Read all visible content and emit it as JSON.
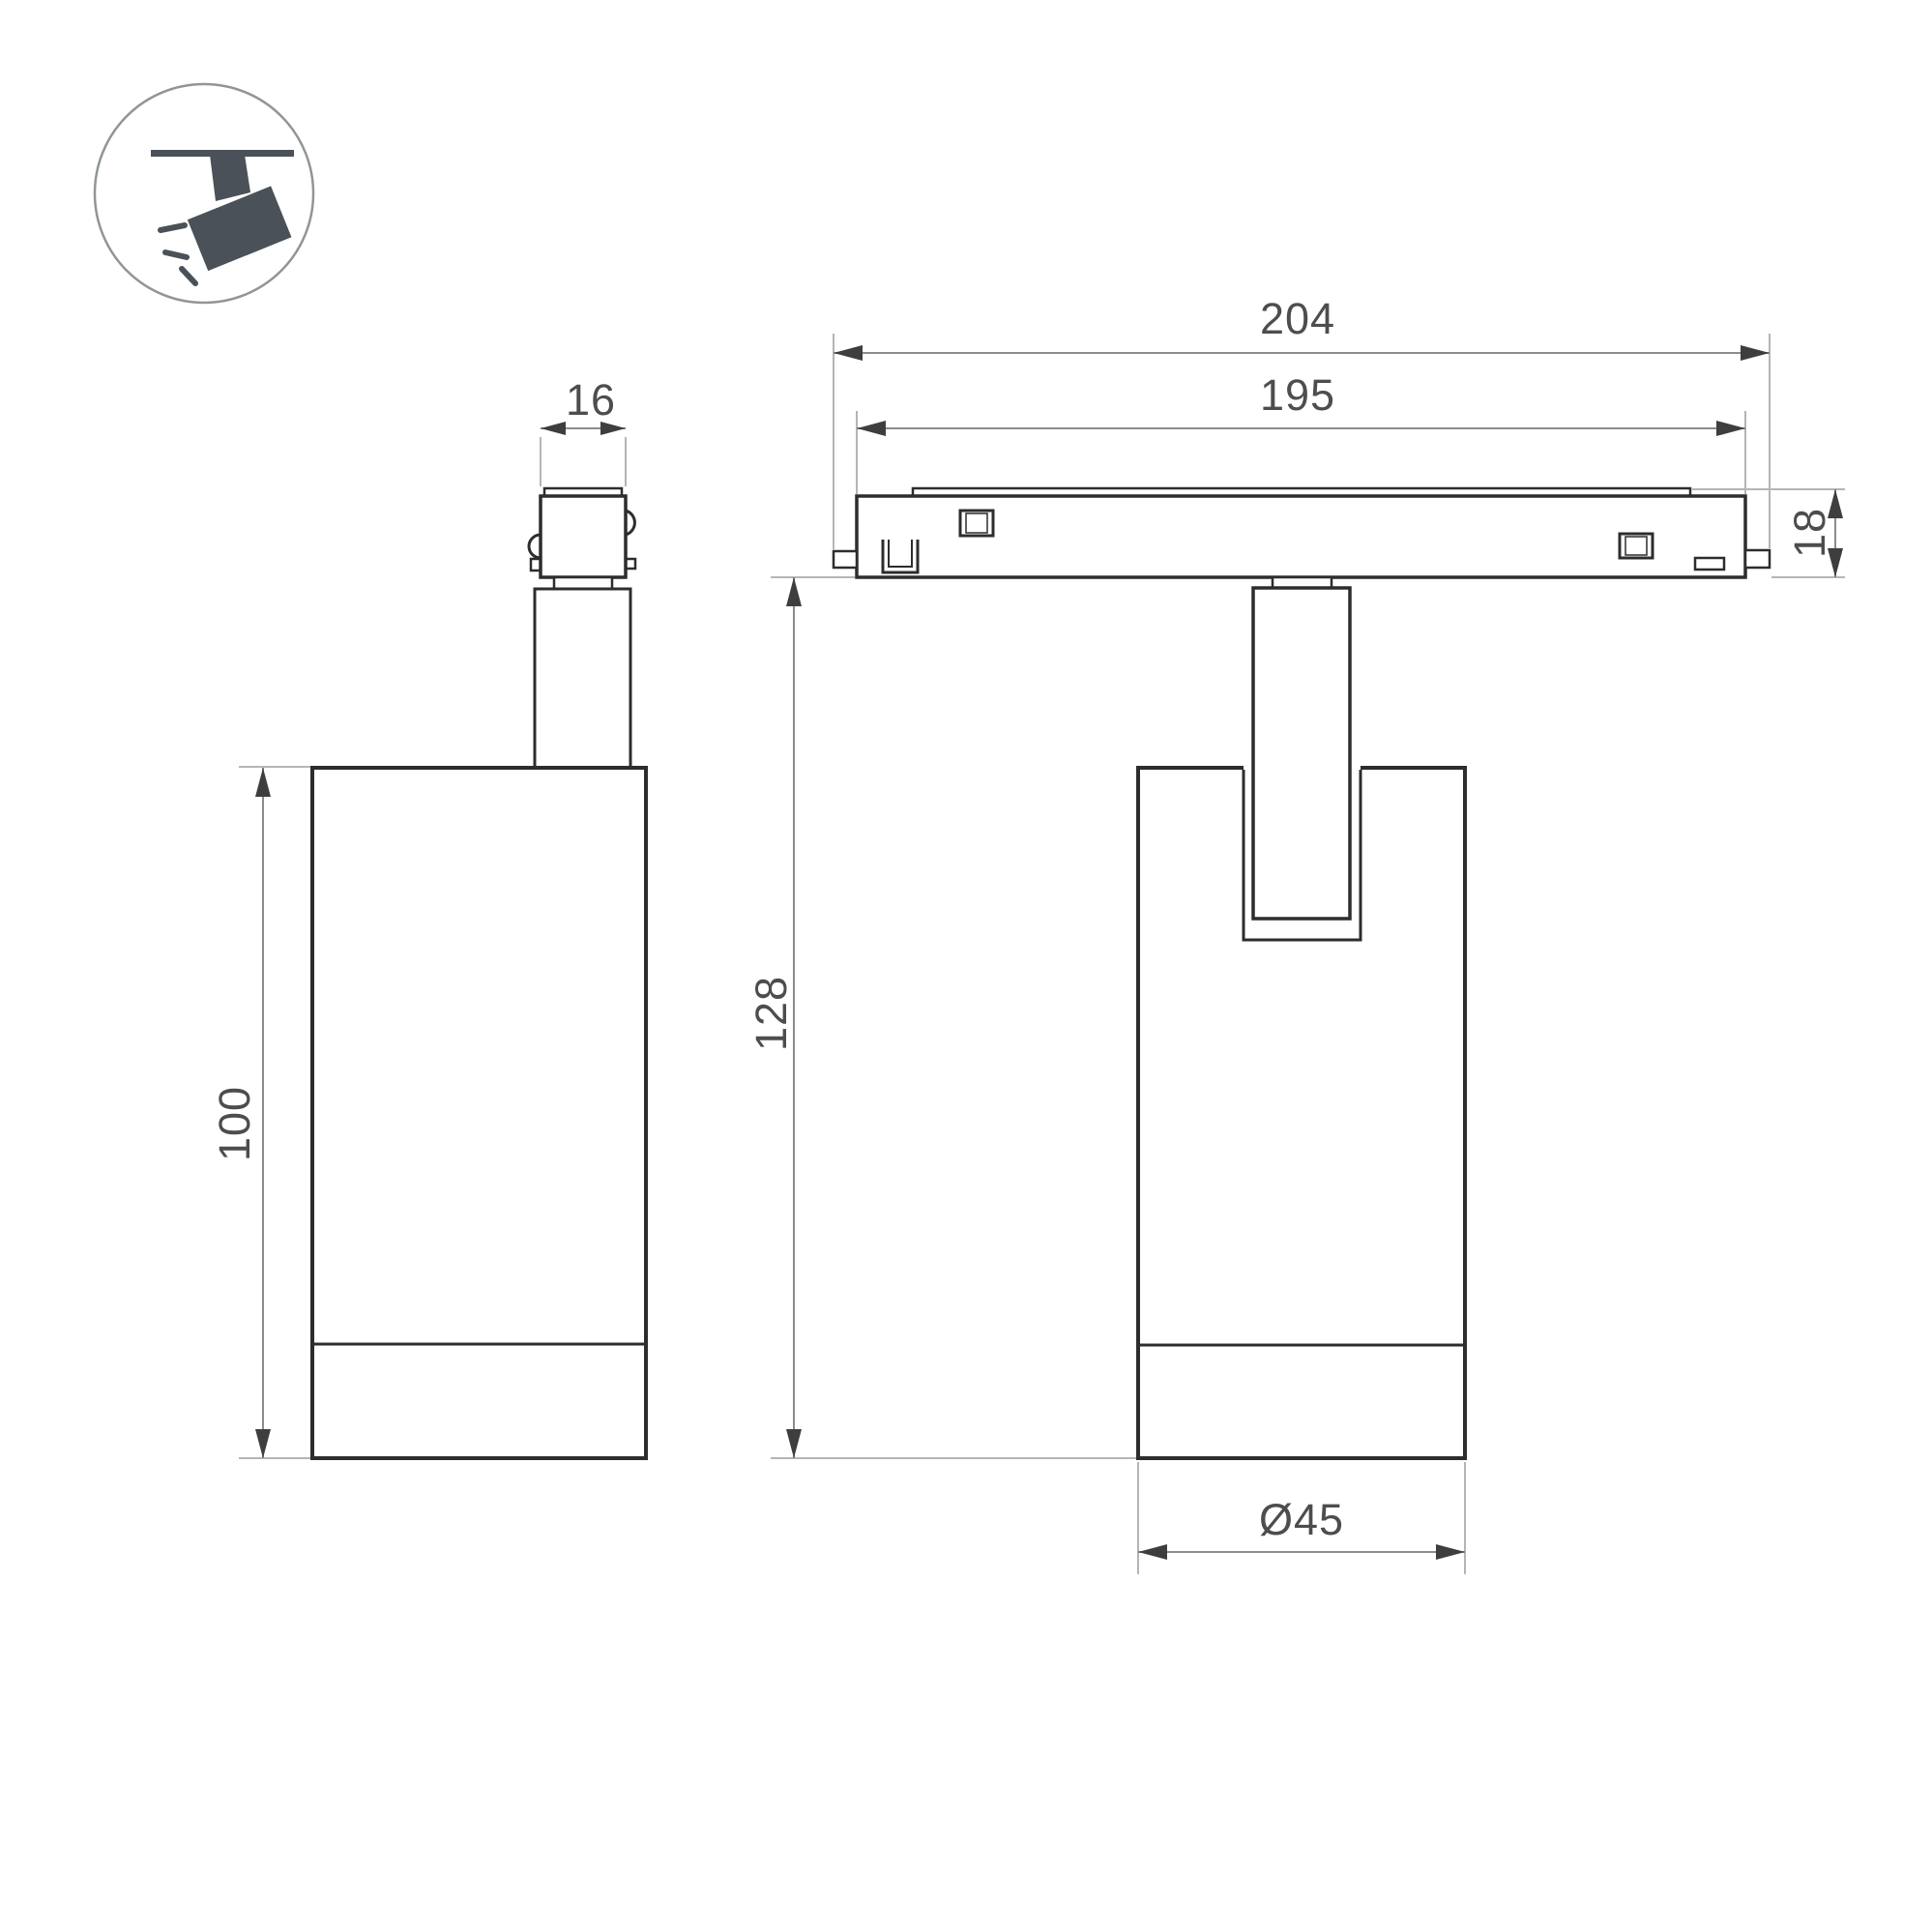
{
  "drawing": {
    "type": "technical-dimension-drawing",
    "subject": "magnetic track spotlight luminaire, two orthographic views",
    "icon": {
      "name": "track-spotlight-icon",
      "description": "spotlight hanging from ceiling track, tilted, emitting light rays"
    },
    "dims": {
      "d16": "16",
      "d204": "204",
      "d195": "195",
      "d18": "18",
      "d100": "100",
      "d128": "128",
      "d45": "Ø45"
    },
    "dimension_meanings": {
      "d16": "adapter width",
      "d204": "track adapter overall length",
      "d195": "track adapter body length",
      "d18": "track adapter height",
      "d100": "lamp body height",
      "d128": "overall hanging height below track",
      "d45": "lamp body diameter"
    },
    "colors": {
      "background": "#ffffff",
      "outline_dark": "#2d2d2d",
      "dim_line": "#8c8c8c",
      "extension_line": "#b5b5b5",
      "arrowhead": "#3e3e3e",
      "dim_text": "#4d4d4d",
      "icon_fill": "#4a5158",
      "icon_circle_stroke": "#909599"
    }
  }
}
